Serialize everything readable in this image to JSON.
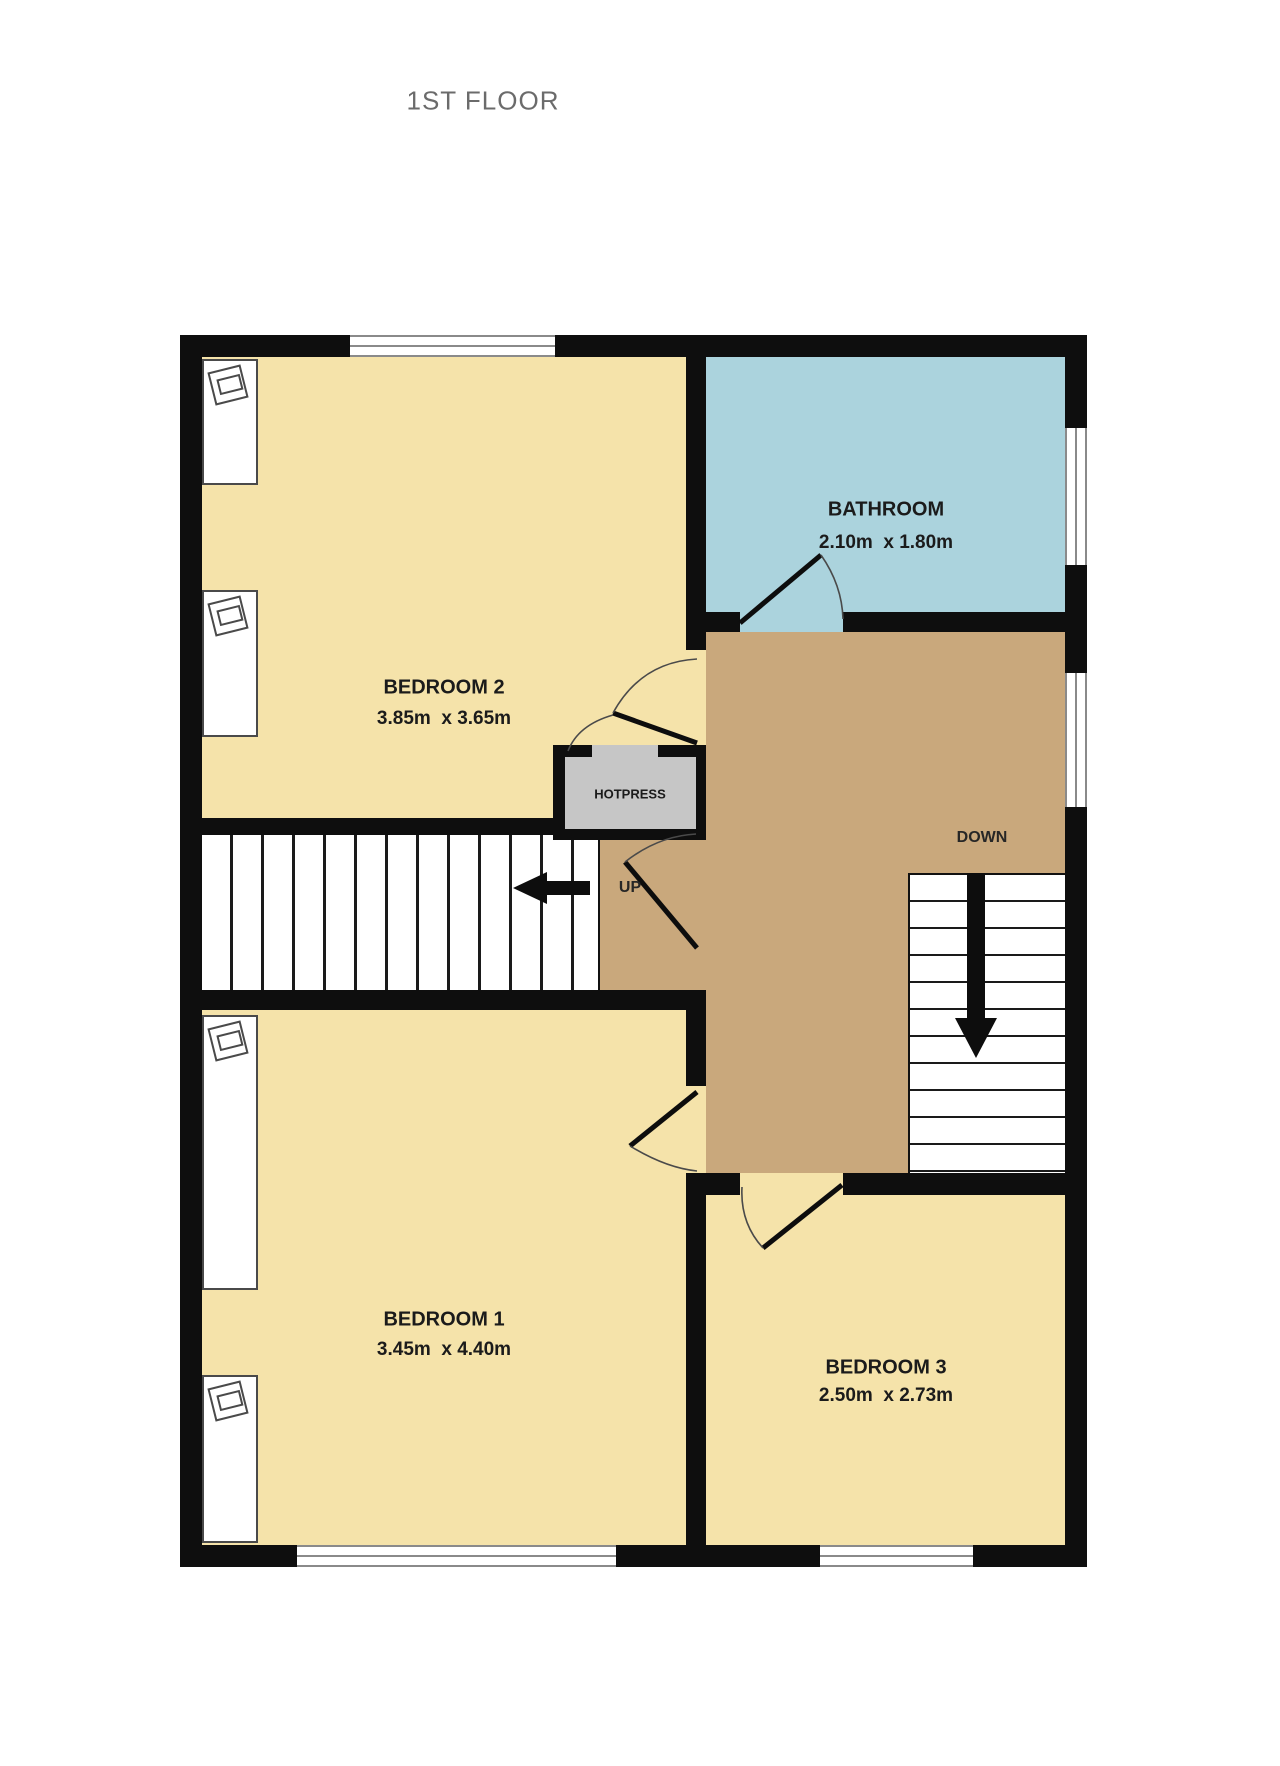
{
  "title": "1ST FLOOR",
  "rooms": {
    "bedroom2": {
      "name": "BEDROOM 2",
      "dims": "3.85m  x 3.65m"
    },
    "bathroom": {
      "name": "BATHROOM",
      "dims": "2.10m  x 1.80m"
    },
    "bedroom1": {
      "name": "BEDROOM 1",
      "dims": "3.45m  x 4.40m"
    },
    "bedroom3": {
      "name": "BEDROOM 3",
      "dims": "2.50m  x 2.73m"
    }
  },
  "labels": {
    "hotpress": "HOTPRESS",
    "stairs_up": "UP",
    "stairs_down": "DOWN"
  },
  "colors": {
    "bedroom_fill": "#f5e3aa",
    "bathroom_fill": "#abd3dd",
    "hall_fill": "#c9a87c",
    "hotpress_fill": "#c6c6c6",
    "wall": "#0e0e0e",
    "title_text": "#6b6b6b",
    "label_text": "#1b1b1b"
  }
}
